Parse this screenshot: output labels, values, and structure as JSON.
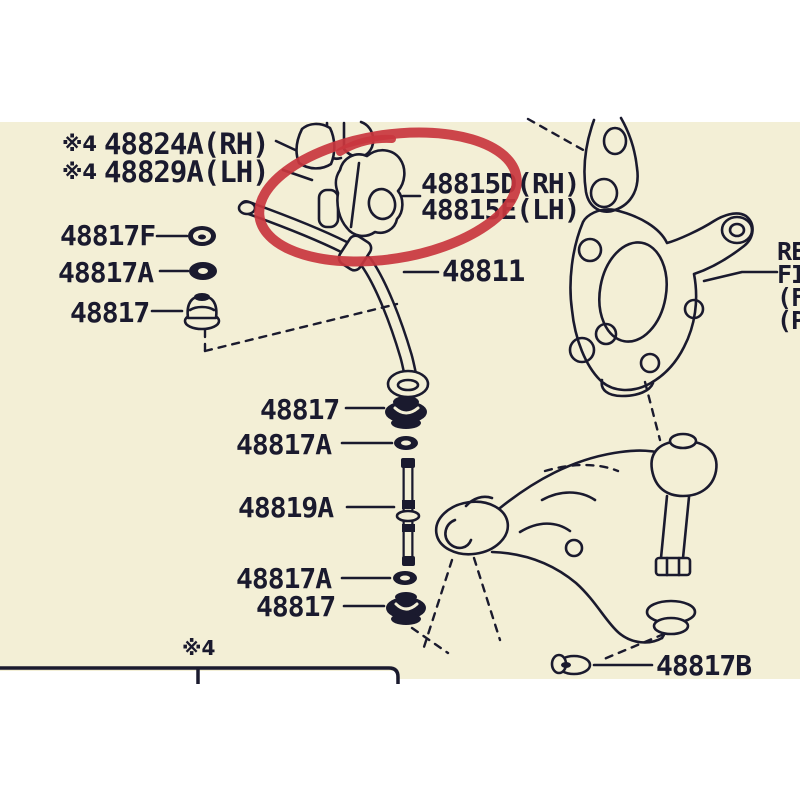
{
  "colors": {
    "paper": "#f3efd6",
    "ink": "#1a1a2e",
    "highlight": "#c9363e"
  },
  "stabilizer_bracket": {
    "prefix": "※4",
    "rh_label": "48824A(RH)",
    "lh_label": "48829A(LH)"
  },
  "left_parts": [
    {
      "label": "48817F",
      "icon": "nut-icon"
    },
    {
      "label": "48817A",
      "icon": "washer-icon"
    },
    {
      "label": "48817",
      "icon": "grommet-icon"
    }
  ],
  "bushing": {
    "rh_label": "48815D(RH)",
    "lh_label": "48815E(LH)",
    "highlighted": true,
    "highlight_shape": "hand-drawn-ellipse"
  },
  "stabilizer_bar_label": "48811",
  "link_parts": [
    {
      "label": "48817",
      "icon": "cushion-icon"
    },
    {
      "label": "48817A",
      "icon": "washer-icon"
    },
    {
      "label": "48819A",
      "icon": "link-rod-icon"
    },
    {
      "label": "48817A",
      "icon": "washer-icon"
    },
    {
      "label": "48817",
      "icon": "cushion-icon"
    }
  ],
  "arm_bolt_label": "48817B",
  "side_note_lines": [
    "RE",
    "FI",
    "(F",
    "(P"
  ],
  "footnote_marker": "※4"
}
